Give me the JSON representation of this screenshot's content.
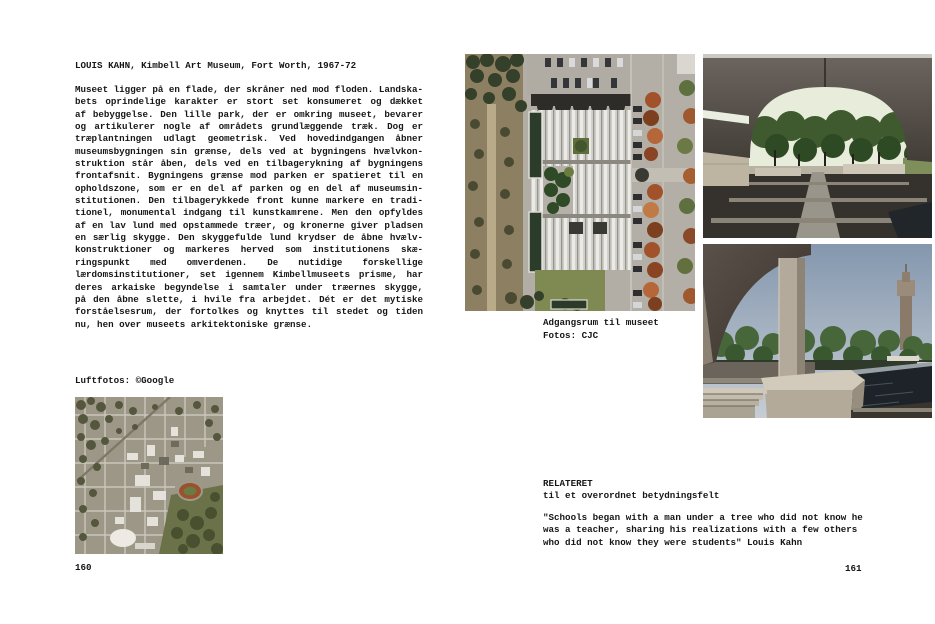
{
  "left_page": {
    "title": "LOUIS KAHN, Kimbell Art Museum, Fort Worth, 1967-72",
    "body_lines": [
      "Museet ligger på en flade, der skråner ned mod floden. Landska-",
      "bets oprindelige karakter er stort set konsumeret og dækket",
      "af bebyggelse. Den lille park, der er omkring museet, bevarer",
      "og artikulerer nogle af områdets grundlæggende træk. Dog er",
      "træplantningen udlagt geometrisk. Ved hovedindgangen åbner",
      "museumsbygningen sin grænse, dels ved at bygningens hvælvkon-",
      "struktion står åben, dels ved en tilbagerykning af bygningens",
      "frontafsnit. Bygningens grænse mod parken er spatieret til en",
      "opholdszone, som er en del af parken og en del af museumsin-",
      "stitutionen. Den tilbagerykkede front kunne markere en tradi-",
      "tionel, monumental indgang til kunstkamrene. Men den opfyldes",
      "af en lav lund med opstammede træer, og kronerne giver pladsen",
      "en særlig skygge. Den skyggefulde lund krydser de åbne hvælv-",
      "konstruktioner og markeres herved som institutionens skæ-",
      "ringspunkt med omverdenen. De nutidige forskellige",
      "lærdomsinstitutioner, set igennem Kimbellmuseets prisme, har",
      "deres arkaiske begyndelse i samtaler under træernes skygge,",
      "på den åbne slette, i hvile fra arbejdet. Dét er det mytiske",
      "forståelsesrum, der fortolkes og knyttes til stedet og tiden",
      "nu, hen over museets arkitektoniske grænse."
    ],
    "aerial_caption": "Luftfotos: ©Google",
    "page_number": "160"
  },
  "right_page": {
    "photo_caption_line1": "Adgangsrum til museet",
    "photo_caption_line2": "Fotos: CJC",
    "related_heading": "RELATERET",
    "related_subheading": "til et overordnet betydningsfelt",
    "quote_lines": [
      "\"Schools began with a man under a tree who did not know he",
      "was a teacher, sharing his realizations with a few others",
      "who did not know they were students\" Louis Kahn"
    ],
    "page_number": "161"
  },
  "images": {
    "city_aerial": "aerial-photo-fort-worth-city",
    "museum_aerial": "aerial-photo-kimbell-museum",
    "portico_view": "photo-vaulted-portico-grove",
    "pool_view": "photo-portico-pool-tower"
  },
  "colors": {
    "paper": "#ffffff",
    "ink": "#161616",
    "roof_gray": "#d6d4cf",
    "tree_green": "#3d4a2c",
    "autumn_orange": "#a1522a",
    "water_dark": "#1d2329",
    "sky_blue": "#8497ae"
  }
}
